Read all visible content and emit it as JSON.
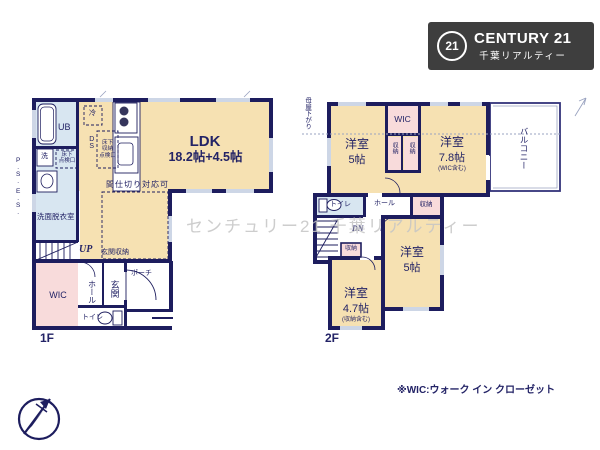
{
  "colors": {
    "wall": "#1d1d5e",
    "room": "#f6e1b2",
    "wet": "#d8e6f1",
    "closet": "#f8dbdb",
    "window": "#cdd6e6",
    "text": "#232366",
    "logo_bg": "#3e3e3e",
    "watermark": "#c5c5c5"
  },
  "logo": {
    "badge": "21",
    "brand": "CENTURY 21",
    "subtitle": "千葉リアルティー"
  },
  "watermark": "センチュリー21 千葉リアルティー",
  "footnote": "※WIC:ウォーク イン クローゼット",
  "floor1": {
    "label": "1F",
    "ldk": {
      "name": "LDK",
      "size": "18.2帖+4.5帖"
    },
    "partition_note": "間仕切り対応可",
    "entrance_storage": "玄関収納",
    "stairs_up": "UP",
    "wic": "WIC",
    "hall": "ホール",
    "entrance": "玄関",
    "toilet": "トイレ",
    "porch": "ポーチ",
    "washroom": "洗面脱衣室",
    "bath": "UB",
    "washer": "洗",
    "fridge": "冷",
    "duct": "DS",
    "hatch_small": [
      "床下",
      "点検口"
    ],
    "hatch_storage": [
      "床下",
      "収納",
      "点検口"
    ],
    "pipe_space": "P.S.",
    "electric_space": "E.S."
  },
  "floor2": {
    "label": "2F",
    "room5a": {
      "name": "洋室",
      "size": "5帖"
    },
    "wic": "WIC",
    "closet_a": "収納",
    "closet_b": "収納",
    "room78": {
      "name": "洋室",
      "size": "7.8帖",
      "note": "(WIC含む)"
    },
    "balcony": "バルコニー",
    "eaves_note": "母屋下がり",
    "toilet": "トイレ",
    "hall": "ホール",
    "closet_c": "収納",
    "stairs_down": "DN",
    "closet_d": "収納",
    "room5b": {
      "name": "洋室",
      "size": "5帖"
    },
    "room47": {
      "name": "洋室",
      "size": "4.7帖",
      "note": "(収納含む)"
    }
  }
}
